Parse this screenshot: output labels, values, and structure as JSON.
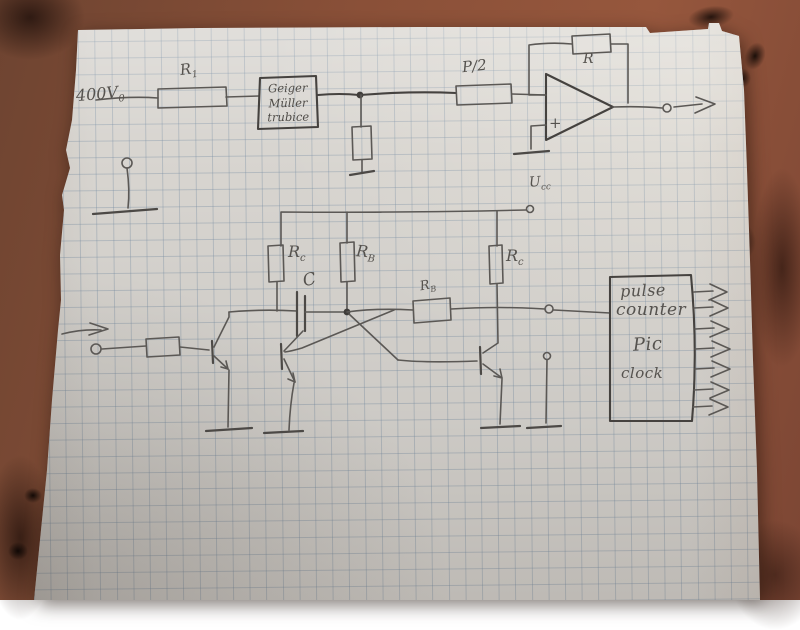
{
  "photo": {
    "table_color": "#8a5038",
    "paper_color": "#d8d5d0",
    "grid_color": "#768ca2",
    "pencil_color": "#5b5855"
  },
  "top_circuit": {
    "supply_label": {
      "base": "400V",
      "sub": "0"
    },
    "r1_label": {
      "base": "R",
      "sub": "1"
    },
    "gm_tube_box": {
      "line1": "Geiger",
      "line2": "Müller",
      "line3": "trubice"
    },
    "pot_label": "P/2",
    "feedback_resistor_label": "R",
    "opamp_plus_label": "+"
  },
  "bottom_circuit": {
    "vcc_label": {
      "base": "U",
      "sub": "cc"
    },
    "rc_left_label": {
      "base": "R",
      "sub": "c"
    },
    "rb_left_label": {
      "base": "R",
      "sub": "B"
    },
    "rc_right_label": {
      "base": "R",
      "sub": "c"
    },
    "rb_cross_label": {
      "base": "R",
      "sub": "B"
    },
    "capacitor_label": "C",
    "counter_box": {
      "line1": "pulse",
      "line2": "counter",
      "line3": "Pic",
      "line4": "clock"
    }
  }
}
